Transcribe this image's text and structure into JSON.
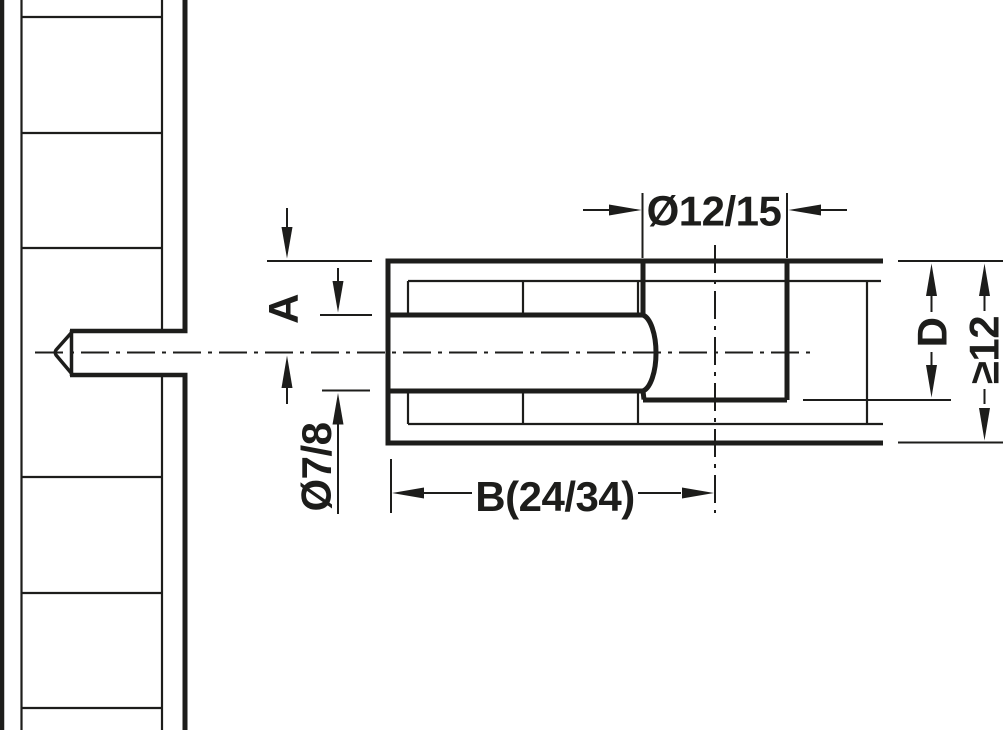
{
  "drawing_title": "Connecting bolt drilling diagram",
  "dimensions": {
    "top_diameter": "Ø12/15",
    "edge_distance": "A",
    "bolt_diameter": "Ø7/8",
    "depth": "B(24/34)",
    "bore_depth": "D",
    "panel_thickness": "≥12"
  },
  "colors": {
    "line": "#1d1d1b",
    "background": "#ffffff"
  }
}
